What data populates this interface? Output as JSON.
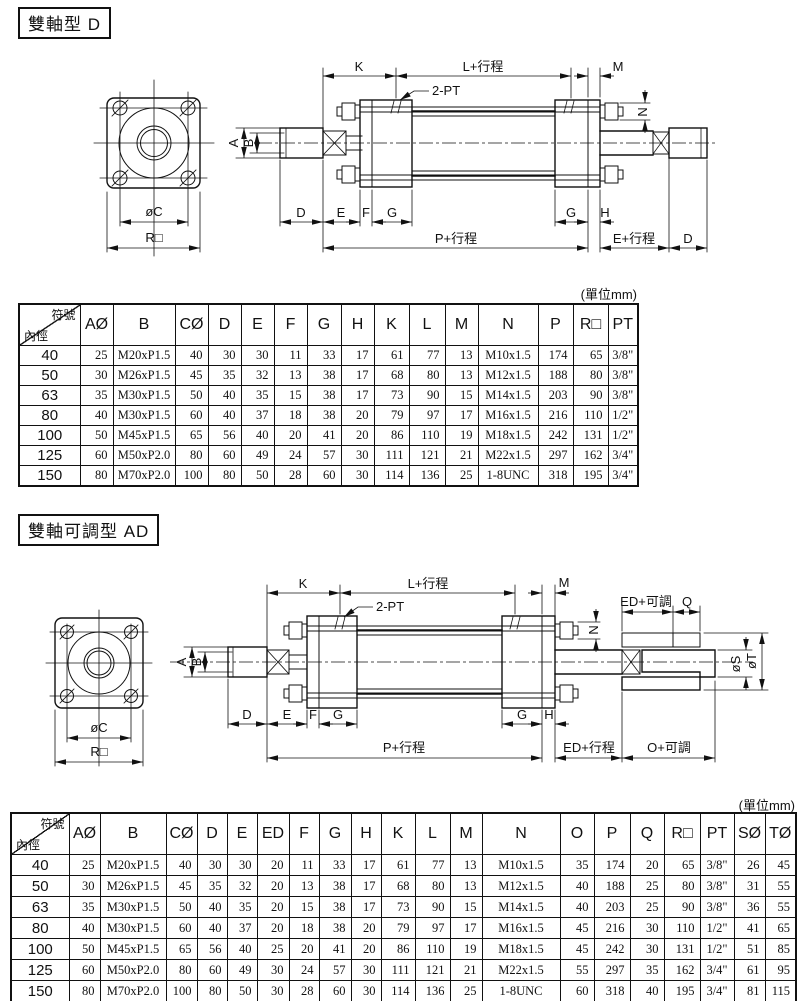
{
  "page": {
    "background": "#ffffff",
    "ink": "#111111"
  },
  "sections": {
    "d": {
      "title": "雙軸型 D",
      "unit_note": "(單位mm)",
      "drawing": {
        "labels": {
          "k": "K",
          "l_stroke": "L+行程",
          "m": "M",
          "two_pt": "2-PT",
          "n": "N",
          "a": "A",
          "b": "B",
          "d": "D",
          "e": "E",
          "f": "F",
          "g": "G",
          "g2": "G",
          "h": "H",
          "p_stroke": "P+行程",
          "e_stroke": "E+行程",
          "d2": "D",
          "phi_c": "øC",
          "r_square": "R□"
        }
      },
      "table": {
        "corner": {
          "top": "符號",
          "bottom": "內徑"
        },
        "columns": [
          "AØ",
          "B",
          "CØ",
          "D",
          "E",
          "F",
          "G",
          "H",
          "K",
          "L",
          "M",
          "N",
          "P",
          "R□",
          "PT"
        ],
        "rows": [
          {
            "bore": "40",
            "values": [
              "25",
              "M20xP1.5",
              "40",
              "30",
              "30",
              "11",
              "33",
              "17",
              "61",
              "77",
              "13",
              "M10x1.5",
              "174",
              "65",
              "3/8\""
            ]
          },
          {
            "bore": "50",
            "values": [
              "30",
              "M26xP1.5",
              "45",
              "35",
              "32",
              "13",
              "38",
              "17",
              "68",
              "80",
              "13",
              "M12x1.5",
              "188",
              "80",
              "3/8\""
            ]
          },
          {
            "bore": "63",
            "values": [
              "35",
              "M30xP1.5",
              "50",
              "40",
              "35",
              "15",
              "38",
              "17",
              "73",
              "90",
              "15",
              "M14x1.5",
              "203",
              "90",
              "3/8\""
            ]
          },
          {
            "bore": "80",
            "values": [
              "40",
              "M30xP1.5",
              "60",
              "40",
              "37",
              "18",
              "38",
              "20",
              "79",
              "97",
              "17",
              "M16x1.5",
              "216",
              "110",
              "1/2\""
            ]
          },
          {
            "bore": "100",
            "values": [
              "50",
              "M45xP1.5",
              "65",
              "56",
              "40",
              "20",
              "41",
              "20",
              "86",
              "110",
              "19",
              "M18x1.5",
              "242",
              "131",
              "1/2\""
            ]
          },
          {
            "bore": "125",
            "values": [
              "60",
              "M50xP2.0",
              "80",
              "60",
              "49",
              "24",
              "57",
              "30",
              "111",
              "121",
              "21",
              "M22x1.5",
              "297",
              "162",
              "3/4\""
            ]
          },
          {
            "bore": "150",
            "values": [
              "80",
              "M70xP2.0",
              "100",
              "80",
              "50",
              "28",
              "60",
              "30",
              "114",
              "136",
              "25",
              "1-8UNC",
              "318",
              "195",
              "3/4\""
            ]
          }
        ]
      }
    },
    "ad": {
      "title": "雙軸可調型 AD",
      "unit_note": "(單位mm)",
      "drawing": {
        "labels": {
          "k": "K",
          "l_stroke": "L+行程",
          "m": "M",
          "two_pt": "2-PT",
          "n": "N",
          "a": "A",
          "b": "B",
          "d": "D",
          "e": "E",
          "f": "F",
          "g": "G",
          "g2": "G",
          "h": "H",
          "p_stroke": "P+行程",
          "ed_stroke": "ED+行程",
          "o_adj": "O+可調",
          "ed_adj": "ED+可調",
          "q": "Q",
          "phi_s": "øS",
          "phi_t": "øT",
          "phi_c": "øC",
          "r_square": "R□"
        }
      },
      "table": {
        "corner": {
          "top": "符號",
          "bottom": "內徑"
        },
        "columns": [
          "AØ",
          "B",
          "CØ",
          "D",
          "E",
          "ED",
          "F",
          "G",
          "H",
          "K",
          "L",
          "M",
          "N",
          "O",
          "P",
          "Q",
          "R□",
          "PT",
          "SØ",
          "TØ"
        ],
        "rows": [
          {
            "bore": "40",
            "values": [
              "25",
              "M20xP1.5",
              "40",
              "30",
              "30",
              "20",
              "11",
              "33",
              "17",
              "61",
              "77",
              "13",
              "M10x1.5",
              "35",
              "174",
              "20",
              "65",
              "3/8\"",
              "26",
              "45"
            ]
          },
          {
            "bore": "50",
            "values": [
              "30",
              "M26xP1.5",
              "45",
              "35",
              "32",
              "20",
              "13",
              "38",
              "17",
              "68",
              "80",
              "13",
              "M12x1.5",
              "40",
              "188",
              "25",
              "80",
              "3/8\"",
              "31",
              "55"
            ]
          },
          {
            "bore": "63",
            "values": [
              "35",
              "M30xP1.5",
              "50",
              "40",
              "35",
              "20",
              "15",
              "38",
              "17",
              "73",
              "90",
              "15",
              "M14x1.5",
              "40",
              "203",
              "25",
              "90",
              "3/8\"",
              "36",
              "55"
            ]
          },
          {
            "bore": "80",
            "values": [
              "40",
              "M30xP1.5",
              "60",
              "40",
              "37",
              "20",
              "18",
              "38",
              "20",
              "79",
              "97",
              "17",
              "M16x1.5",
              "45",
              "216",
              "30",
              "110",
              "1/2\"",
              "41",
              "65"
            ]
          },
          {
            "bore": "100",
            "values": [
              "50",
              "M45xP1.5",
              "65",
              "56",
              "40",
              "25",
              "20",
              "41",
              "20",
              "86",
              "110",
              "19",
              "M18x1.5",
              "45",
              "242",
              "30",
              "131",
              "1/2\"",
              "51",
              "85"
            ]
          },
          {
            "bore": "125",
            "values": [
              "60",
              "M50xP2.0",
              "80",
              "60",
              "49",
              "30",
              "24",
              "57",
              "30",
              "111",
              "121",
              "21",
              "M22x1.5",
              "55",
              "297",
              "35",
              "162",
              "3/4\"",
              "61",
              "95"
            ]
          },
          {
            "bore": "150",
            "values": [
              "80",
              "M70xP2.0",
              "100",
              "80",
              "50",
              "30",
              "28",
              "60",
              "30",
              "114",
              "136",
              "25",
              "1-8UNC",
              "60",
              "318",
              "40",
              "195",
              "3/4\"",
              "81",
              "115"
            ]
          }
        ]
      }
    }
  }
}
